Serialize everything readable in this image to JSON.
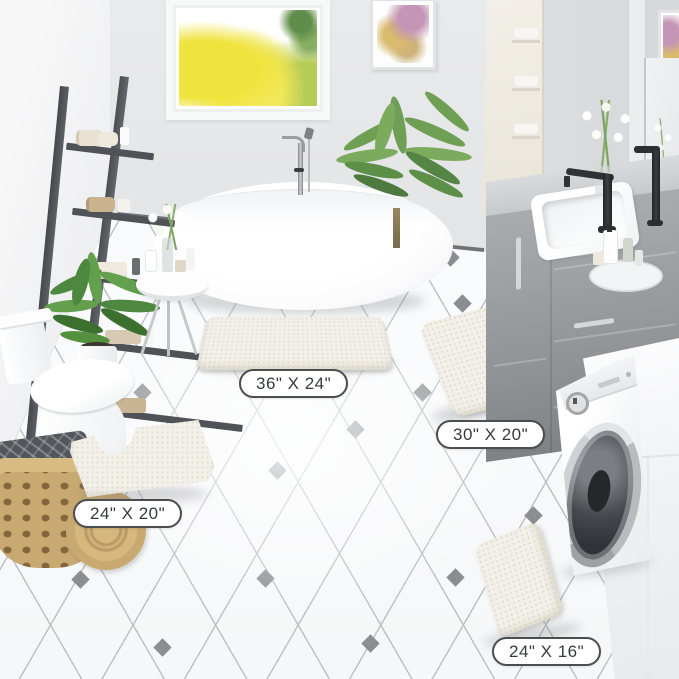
{
  "product_labels": {
    "large": "36\" X 24\"",
    "runner": "30\" X 20\"",
    "contour": "24\" X 20\"",
    "small": "24\" X 16\""
  },
  "colors": {
    "wall": "#e7e8ea",
    "floor_line": "#c7c9cb",
    "floor_diamond": "#8b8e91",
    "ladder": "#4f5256",
    "vanity_gray": "#9ea1a4",
    "rug_cream": "#f2f0e9",
    "label_border": "#4b4e51",
    "label_text": "#383b3e",
    "faucet_black": "#2e3134",
    "window_foliage_yellow": "#efe43d",
    "plant_green": "#6f9f55",
    "basket_tan": "#c9a972"
  },
  "scene": {
    "type": "bathroom-product-photo",
    "items": [
      "window",
      "wall-art",
      "ladder-shelf",
      "freestanding-bathtub",
      "tub-faucet",
      "side-table",
      "palm-plant",
      "toilet",
      "potted-plant",
      "wicker-basket",
      "vanity-sink",
      "black-faucet",
      "mirror",
      "washing-machine",
      "bath-rug-36x24",
      "bath-rug-30x20",
      "contour-rug-24x20",
      "bath-rug-24x16"
    ]
  }
}
